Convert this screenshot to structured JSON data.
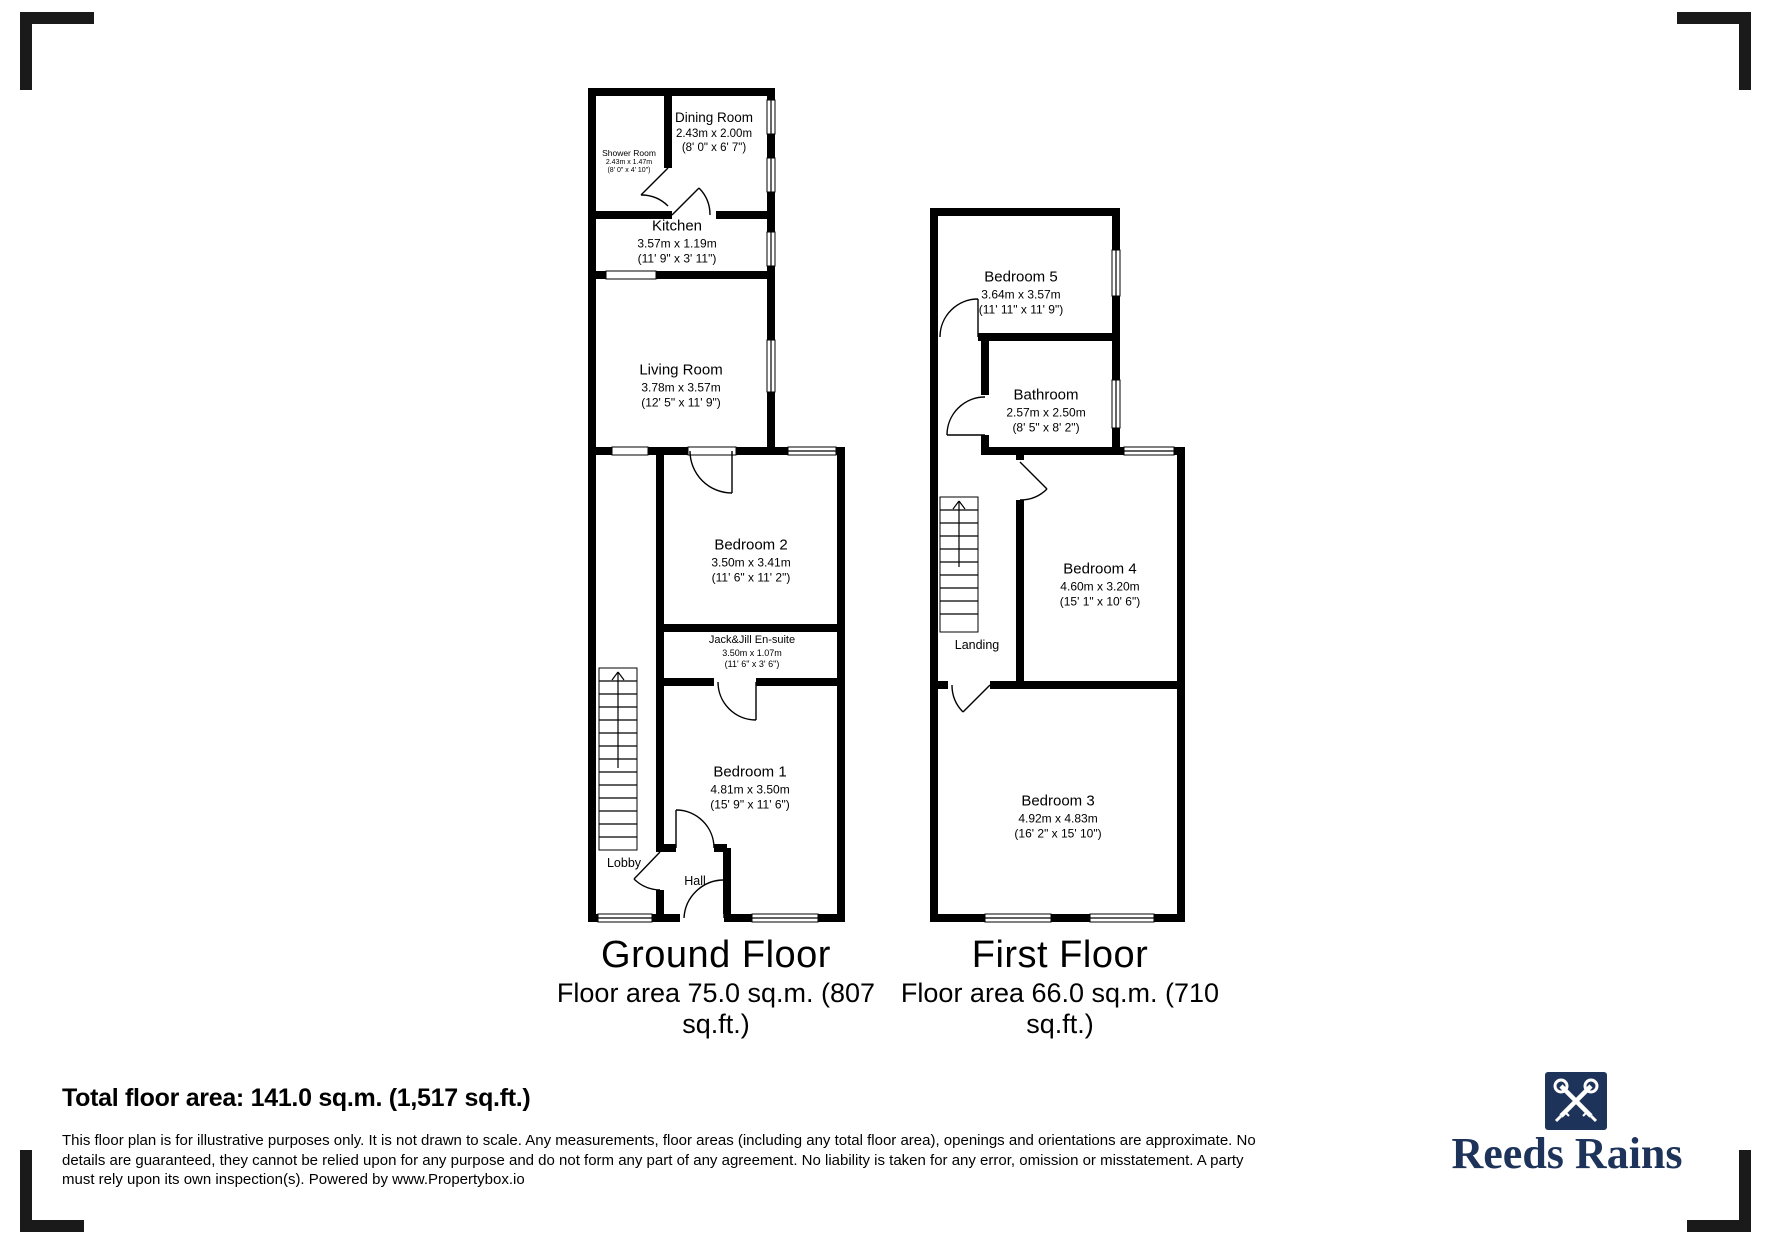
{
  "plan": {
    "ground": {
      "title": "Ground Floor",
      "area_line1": "Floor area 75.0 sq.m. (807",
      "area_line2": "sq.ft.)",
      "rooms": {
        "shower_room": {
          "name": "Shower Room",
          "metric": "2.43m x 1.47m",
          "imperial": "(8' 0\" x 4' 10\")"
        },
        "dining_room": {
          "name": "Dining Room",
          "metric": "2.43m x 2.00m",
          "imperial": "(8' 0\" x 6' 7\")"
        },
        "kitchen": {
          "name": "Kitchen",
          "metric": "3.57m x 1.19m",
          "imperial": "(11' 9\" x 3' 11\")"
        },
        "living_room": {
          "name": "Living Room",
          "metric": "3.78m x 3.57m",
          "imperial": "(12' 5\" x 11' 9\")"
        },
        "bedroom_2": {
          "name": "Bedroom 2",
          "metric": "3.50m x 3.41m",
          "imperial": "(11' 6\" x 11' 2\")"
        },
        "ensuite": {
          "name": "Jack&Jill En-suite",
          "metric": "3.50m x 1.07m",
          "imperial": "(11' 6\" x 3' 6\")"
        },
        "bedroom_1": {
          "name": "Bedroom 1",
          "metric": "4.81m x 3.50m",
          "imperial": "(15' 9\" x 11' 6\")"
        },
        "lobby": {
          "name": "Lobby"
        },
        "hall": {
          "name": "Hall"
        }
      }
    },
    "first": {
      "title": "First Floor",
      "area_line1": "Floor area 66.0 sq.m. (710",
      "area_line2": "sq.ft.)",
      "rooms": {
        "bedroom_5": {
          "name": "Bedroom 5",
          "metric": "3.64m x 3.57m",
          "imperial": "(11' 11\" x 11' 9\")"
        },
        "bathroom": {
          "name": "Bathroom",
          "metric": "2.57m x 2.50m",
          "imperial": "(8' 5\" x 8' 2\")"
        },
        "bedroom_4": {
          "name": "Bedroom 4",
          "metric": "4.60m x 3.20m",
          "imperial": "(15' 1\" x 10' 6\")"
        },
        "landing": {
          "name": "Landing"
        },
        "bedroom_3": {
          "name": "Bedroom 3",
          "metric": "4.92m x 4.83m",
          "imperial": "(16' 2\" x 15' 10\")"
        }
      }
    }
  },
  "summary": {
    "total_area": "Total floor area: 141.0 sq.m. (1,517 sq.ft.)"
  },
  "disclaimer": {
    "line1": "This floor plan is for illustrative purposes only. It is not drawn to scale. Any measurements, floor areas (including any total floor area), openings and orientations are approximate. No",
    "line2": "details are guaranteed, they cannot be relied upon for any purpose and do not form any part of any agreement. No liability is taken for any error, omission or misstatement. A party",
    "line3": "must rely upon its own inspection(s). Powered by www.Propertybox.io"
  },
  "brand": {
    "name": "Reeds Rains",
    "color": "#1D3359"
  },
  "colors": {
    "wall": "#000000",
    "background": "#FFFFFF"
  }
}
